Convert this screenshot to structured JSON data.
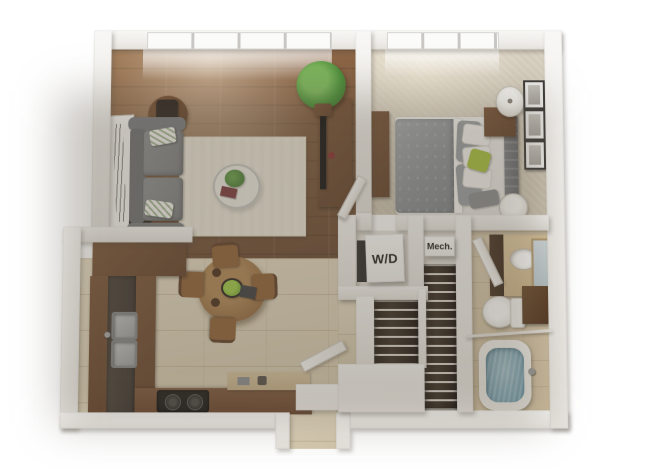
{
  "labels": {
    "washer_dryer": "W/D",
    "mechanical": "Mech."
  },
  "palette": {
    "background": "#ffffff",
    "wall": "#f3f1ee",
    "wood_floor": "#846042",
    "tile_floor": "#ddd2ba",
    "carpet": "#d7cfc0",
    "bath_tile": "#d6c7ab",
    "cabinet_brown": "#6e4c33",
    "countertop_dark": "#433b34",
    "sofa_gray": "#85878a",
    "rug_cream": "#ece7da",
    "bed_gray": "#9aa0a4",
    "accent_green": "#a9c23f",
    "plant_green": "#4e8f3c",
    "tub_water_blue": "#7fa7b6",
    "tv_black": "#141414"
  },
  "rooms": {
    "living_room": {
      "floor": "hardwood",
      "items": [
        "floor-to-ceiling-window",
        "gray-sofa",
        "striped-throw-pillows",
        "area-rug",
        "glass-coffee-table",
        "coffee-table-plant",
        "book",
        "side-table-top",
        "table-lamp-top",
        "side-table-bottom",
        "table-lamp-bottom",
        "leaning-wall-art",
        "media-console",
        "tv",
        "tall-potted-plant"
      ]
    },
    "bedroom": {
      "floor": "carpet",
      "items": [
        "window",
        "bed",
        "gray-patterned-duvet",
        "white-pillows",
        "gray-pillows",
        "green-accent-pillow",
        "tufted-headboard",
        "nightstand",
        "table-lamp",
        "dresser",
        "tv",
        "gallery-frames",
        "floor-vase",
        "door"
      ]
    },
    "kitchen": {
      "floor": "tile",
      "items": [
        "l-shaped-cabinets",
        "dark-countertop",
        "double-sink",
        "faucet",
        "cooktop",
        "counter-items",
        "upper-cabinet-run"
      ]
    },
    "dining_area": {
      "floor": "tile",
      "items": [
        "round-dining-table",
        "dining-chairs-x4",
        "centerpiece-plant",
        "tablet",
        "decor-bowls"
      ]
    },
    "bathroom": {
      "floor": "tile",
      "items": [
        "vanity-with-sink",
        "leaning-mirror",
        "toilet",
        "storage-cabinet",
        "bathtub",
        "shower-rod",
        "door"
      ]
    },
    "laundry_closet": {
      "items": [
        "stacked-washer-dryer"
      ]
    },
    "mechanical_closet": {
      "items": []
    },
    "walk_in_closet": {
      "items": [
        "hanging-clothes",
        "wire-shelving"
      ]
    },
    "entry": {
      "items": [
        "open-entry-door",
        "vestibule"
      ]
    }
  }
}
